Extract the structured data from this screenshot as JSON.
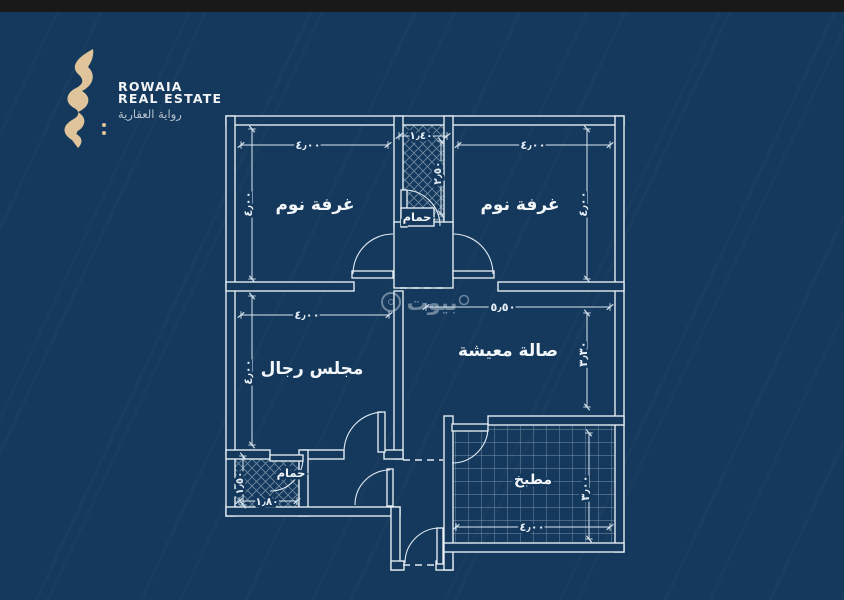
{
  "page": {
    "background_color": "#15395c",
    "top_bar_color": "#191919",
    "line_color": "#e9f1f7"
  },
  "logo": {
    "name_line1": "ROWAIA",
    "name_line2": "REAL ESTATE",
    "name_arabic": "رواية العقارية",
    "gold_color": "#dfc49b"
  },
  "watermark": {
    "text": "بيوت"
  },
  "plan": {
    "rooms": [
      {
        "id": "bedroom-top-left",
        "label": "غرفة نوم",
        "dims": {
          "width": "٤٫٠٠",
          "height": "٤٫٠٠"
        }
      },
      {
        "id": "bathroom-top",
        "label": "حمام",
        "dims": {
          "width": "١٫٤٠",
          "height": "٢٫٥٠"
        }
      },
      {
        "id": "bedroom-top-right",
        "label": "غرفة نوم",
        "dims": {
          "width": "٤٫٠٠",
          "height": "٤٫٠٠"
        }
      },
      {
        "id": "majlis",
        "label": "مجلس رجال",
        "dims": {
          "width": "٤٫٠٠",
          "height": "٤٫٠٠"
        }
      },
      {
        "id": "living-hall",
        "label": "صالة معيشة",
        "dims": {
          "width": "٥٫٥٠",
          "height": "٣٫٣٠"
        }
      },
      {
        "id": "bathroom-bottom",
        "label": "حمام",
        "dims": {
          "width": "١٫٨٠",
          "height": "١٫٥٠"
        }
      },
      {
        "id": "kitchen",
        "label": "مطبخ",
        "dims": {
          "width": "٤٫٠٠",
          "height": "٣٫٠٠"
        }
      }
    ]
  }
}
